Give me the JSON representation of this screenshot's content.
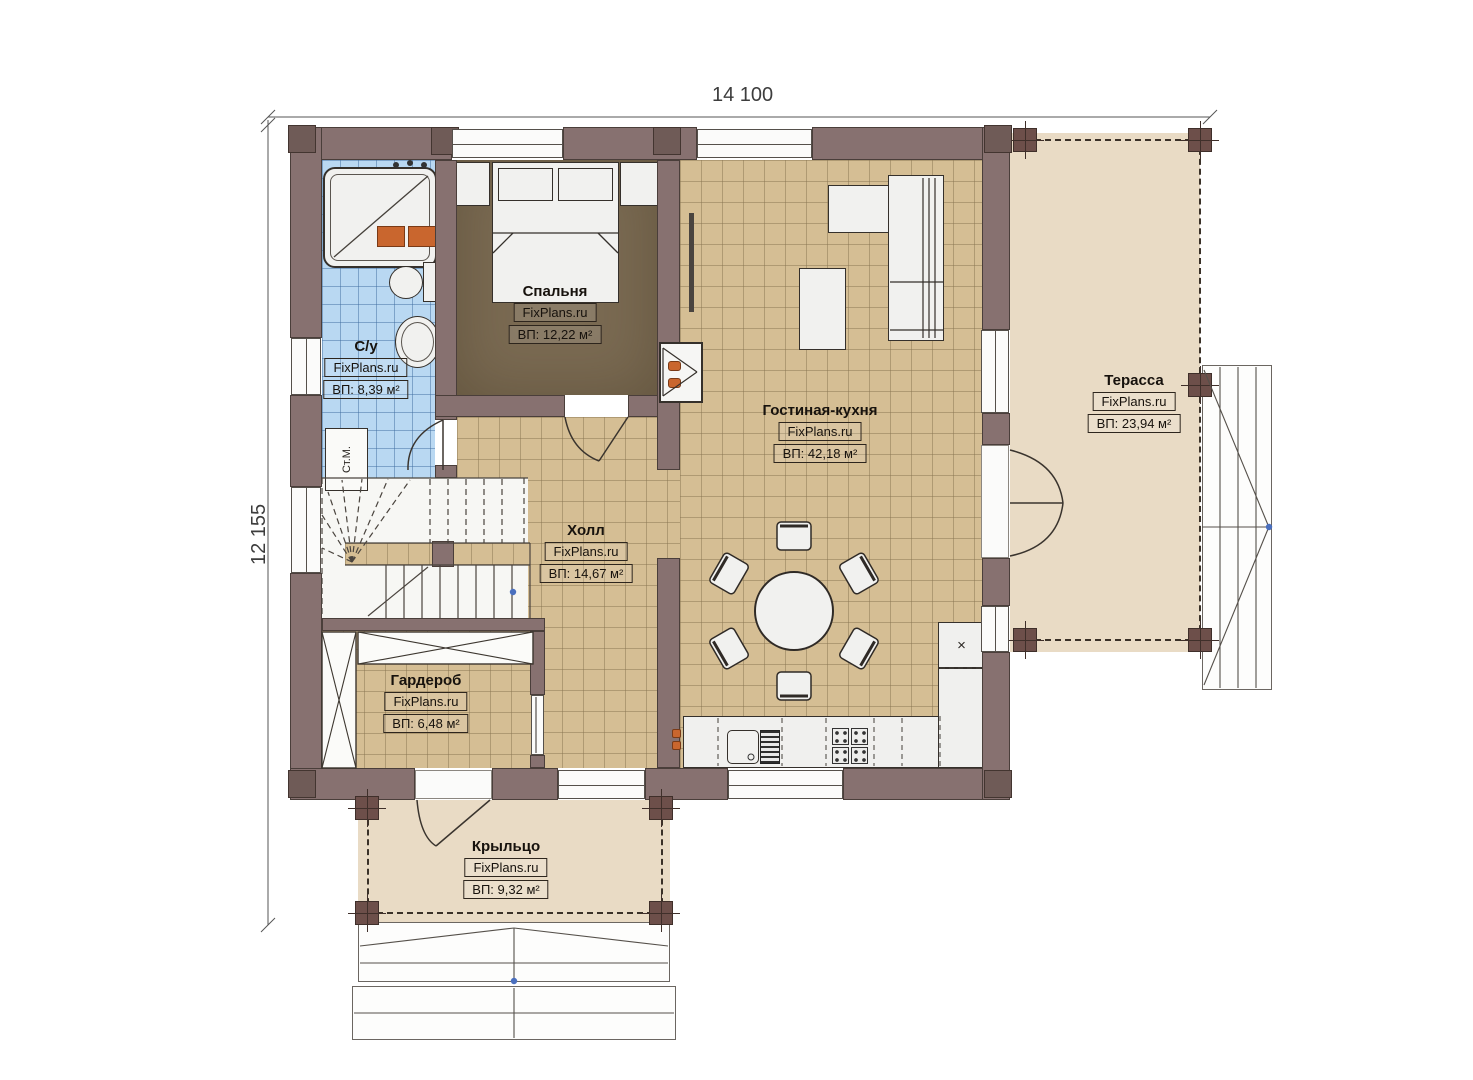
{
  "dimensions": {
    "width": "14 100",
    "height": "12 155"
  },
  "watermark": "FixPlans.ru",
  "rooms": [
    {
      "id": "bedroom",
      "name": "Спальня",
      "brand": "FixPlans.ru",
      "area": "ВП: 12,22 м²"
    },
    {
      "id": "bathroom",
      "name": "С/у",
      "brand": "FixPlans.ru",
      "area": "ВП: 8,39 м²"
    },
    {
      "id": "living-kitchen",
      "name": "Гостиная-кухня",
      "brand": "FixPlans.ru",
      "area": "ВП: 42,18 м²"
    },
    {
      "id": "terrace",
      "name": "Терасса",
      "brand": "FixPlans.ru",
      "area": "ВП: 23,94 м²"
    },
    {
      "id": "hall",
      "name": "Холл",
      "brand": "FixPlans.ru",
      "area": "ВП: 14,67 м²"
    },
    {
      "id": "wardrobe",
      "name": "Гардероб",
      "brand": "FixPlans.ru",
      "area": "ВП: 6,48 м²"
    },
    {
      "id": "porch",
      "name": "Крыльцо",
      "brand": "FixPlans.ru",
      "area": "ВП: 9,32 м²"
    }
  ],
  "annotations": {
    "washing_machine": "Ст.М.",
    "vent_mark": "×"
  },
  "colors": {
    "wall": "#877170",
    "post": "#6d4f4a",
    "floor_tile": "#d5be94",
    "floor_bath": "#b9d8f2",
    "floor_bedroom": "#7a6a52",
    "floor_outdoor": "#e9dbc5",
    "accent_orange": "#c9662e",
    "marker_blue": "#4a6fbe"
  }
}
